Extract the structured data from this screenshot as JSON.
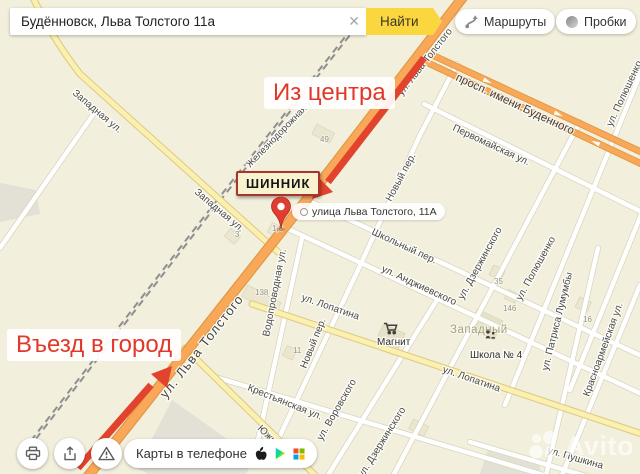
{
  "search_bar": {
    "value": "Будённовск, Льва Толстого 11а",
    "clear_glyph": "✕",
    "submit_label": "Найти"
  },
  "map_controls": {
    "routes_label": "Маршруты",
    "traffic_label": "Пробки"
  },
  "annotations": {
    "from_center": "Из центра",
    "city_entry": "Въезд в город",
    "poi_box": "ШИННИК",
    "address_bubble": "улица Льва Толстого, 11А"
  },
  "map": {
    "street_labels": [
      "ул. Льва Толстого",
      "просп. имени Буденного",
      "Первомайская ул.",
      "ул. Полюшенко",
      "Железнодорожная ул.",
      "Западная ул.",
      "Западная ул.",
      "Новый пер.",
      "Школьный пер.",
      "ул. Анджиевского",
      "ул. Дзержинского",
      "ул. Полюшенко",
      "ул. Патриса Лумумбы",
      "Красноармейская ул.",
      "ул. Воровского",
      "Водопроводная ул.",
      "Новый пер.",
      "Крестьянская ул.",
      "Южная ул.",
      "ул. Лопатина",
      "ул. Лопатина",
      "ул. Льва Толстого",
      "ул. Дзержинского",
      "ул. Пушкина"
    ],
    "district_label": "Западный",
    "pois": [
      {
        "label": "Магнит"
      },
      {
        "label": "Школа № 4"
      }
    ],
    "building_numbers": [
      "49",
      "138",
      "3",
      "1,6",
      "11",
      "35",
      "146",
      "16"
    ]
  },
  "bottom_bar": {
    "apps_label": "Карты в телефоне",
    "watermark_text": "Avito"
  },
  "icons": {
    "clear": "✕",
    "routes": "route-curve",
    "traffic": "traffic-light-circle",
    "print": "printer",
    "share": "share-arrow",
    "warning": "warning-triangle",
    "apple": "apple-logo",
    "google_play": "play-triangle",
    "app_grid": "four-squares",
    "avito_logo": "four-dots",
    "magnit": "shopping-cart",
    "school": "people-figures",
    "pin": "map-pin"
  },
  "colors": {
    "accent_yellow": "#fbd73f",
    "annotation_red": "#e0382a",
    "arrow_red": "#e2432c",
    "pin_red": "#e03d30",
    "shinnik_border": "#a83430",
    "road_orange": "#f9a85a",
    "road_yellow": "#faf0b0",
    "map_background": "#f3efdd"
  }
}
